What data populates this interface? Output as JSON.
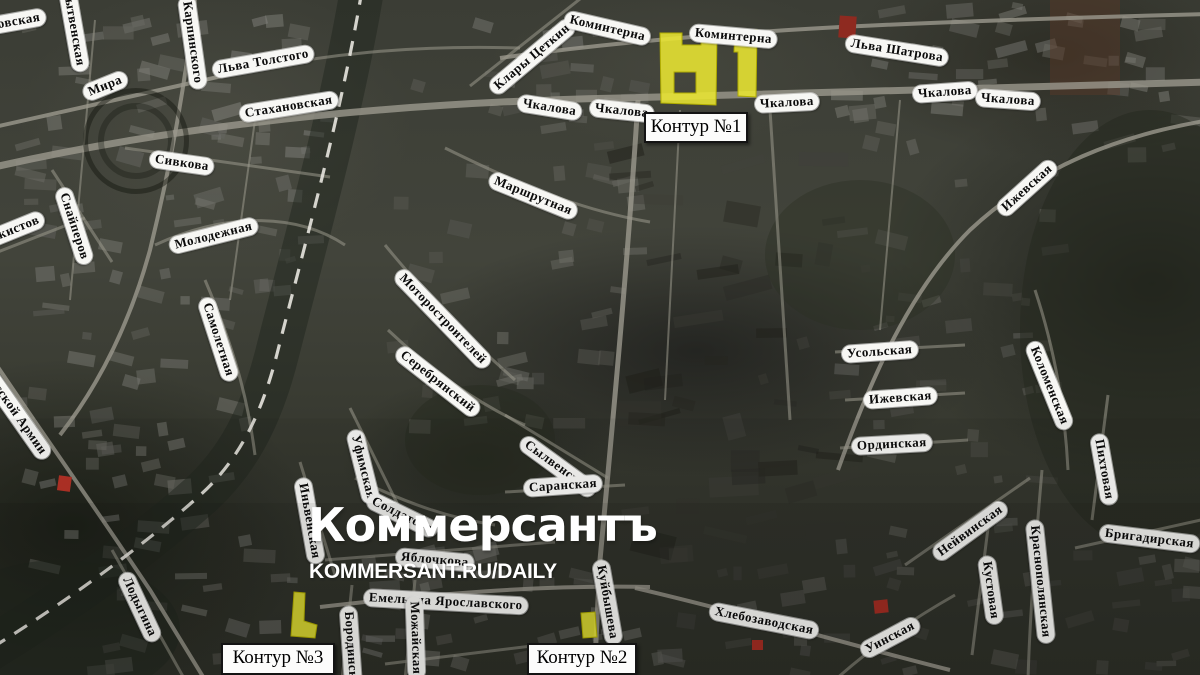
{
  "watermark": {
    "logo": "Коммерсантъ",
    "url": "KOMMERSANT.RU/DAILY"
  },
  "colors": {
    "highlight": "#e9e632",
    "highlight_stroke": "#b0ac00",
    "street_label_bg": "#f7f7f4",
    "street_label_text": "#0b0b0b",
    "callout_bg": "#fcfcfb",
    "callout_border": "#141414",
    "ground": "#3e4038",
    "road": "#9b998d",
    "railway_dash": "#e8e6df"
  },
  "map": {
    "street_labels": [
      {
        "text": "Стахановская",
        "x": -52,
        "y": 25,
        "rot": -10
      },
      {
        "text": "Нытвенская",
        "x": 66,
        "y": -25,
        "rot": 80
      },
      {
        "text": "Карпинского",
        "x": 186,
        "y": -12,
        "rot": 82
      },
      {
        "text": "Льва Толстого",
        "x": 213,
        "y": 62,
        "rot": -10
      },
      {
        "text": "Мира",
        "x": 84,
        "y": 86,
        "rot": -22
      },
      {
        "text": "Стахановская",
        "x": 240,
        "y": 106,
        "rot": -9
      },
      {
        "text": "Сивкова",
        "x": 150,
        "y": 150,
        "rot": 8
      },
      {
        "text": "Танкистов",
        "x": -28,
        "y": 238,
        "rot": -22
      },
      {
        "text": "Снайперов",
        "x": 62,
        "y": 180,
        "rot": 72
      },
      {
        "text": "Молодежная",
        "x": 170,
        "y": 238,
        "rot": -14
      },
      {
        "text": "Самолетная",
        "x": 205,
        "y": 290,
        "rot": 72
      },
      {
        "text": "Советской Армии",
        "x": -24,
        "y": 348,
        "rot": 55
      },
      {
        "text": "Маршрутная",
        "x": 490,
        "y": 170,
        "rot": 22
      },
      {
        "text": "Моторостроителей",
        "x": 398,
        "y": 264,
        "rot": 46
      },
      {
        "text": "Серебрянский",
        "x": 398,
        "y": 342,
        "rot": 38
      },
      {
        "text": "Уфимская",
        "x": 354,
        "y": 422,
        "rot": 76
      },
      {
        "text": "Иньвенская",
        "x": 302,
        "y": 470,
        "rot": 80
      },
      {
        "text": "Солдатова",
        "x": 368,
        "y": 490,
        "rot": 26
      },
      {
        "text": "Сылвенская",
        "x": 522,
        "y": 432,
        "rot": 36
      },
      {
        "text": "Саранская",
        "x": 524,
        "y": 480,
        "rot": -4
      },
      {
        "text": "Яблочкова",
        "x": 396,
        "y": 548,
        "rot": 5
      },
      {
        "text": "Емельяна Ярославского",
        "x": 364,
        "y": 589,
        "rot": 3
      },
      {
        "text": "Лодыгина",
        "x": 124,
        "y": 565,
        "rot": 65
      },
      {
        "text": "Бородинская",
        "x": 348,
        "y": 598,
        "rot": 86
      },
      {
        "text": "Можайская",
        "x": 414,
        "y": 588,
        "rot": 88
      },
      {
        "text": "Куйбышева",
        "x": 600,
        "y": 552,
        "rot": 80
      },
      {
        "text": "Хлебозаводская",
        "x": 710,
        "y": 602,
        "rot": 11
      },
      {
        "text": "Уинская",
        "x": 862,
        "y": 644,
        "rot": -28
      },
      {
        "text": "Усольская",
        "x": 842,
        "y": 346,
        "rot": -4
      },
      {
        "text": "Ижевская",
        "x": 864,
        "y": 392,
        "rot": -4
      },
      {
        "text": "Ординская",
        "x": 852,
        "y": 438,
        "rot": -3
      },
      {
        "text": "Ижевская",
        "x": 1000,
        "y": 204,
        "rot": -42
      },
      {
        "text": "Коломенская",
        "x": 1032,
        "y": 334,
        "rot": 68
      },
      {
        "text": "Нейвинская",
        "x": 935,
        "y": 548,
        "rot": -36
      },
      {
        "text": "Кустовая",
        "x": 986,
        "y": 548,
        "rot": 82
      },
      {
        "text": "Краснополянская",
        "x": 1034,
        "y": 512,
        "rot": 84
      },
      {
        "text": "Пихтовая",
        "x": 1098,
        "y": 426,
        "rot": 80
      },
      {
        "text": "Бригадирская",
        "x": 1100,
        "y": 524,
        "rot": 7
      },
      {
        "text": "Клары Цеткин",
        "x": 492,
        "y": 82,
        "rot": -40
      },
      {
        "text": "Коминтерна",
        "x": 565,
        "y": 10,
        "rot": 13
      },
      {
        "text": "Коминтерна",
        "x": 690,
        "y": 24,
        "rot": 5
      },
      {
        "text": "Льва Шатрова",
        "x": 846,
        "y": 34,
        "rot": 9
      },
      {
        "text": "Чкалова",
        "x": 518,
        "y": 94,
        "rot": 9
      },
      {
        "text": "Чкалова",
        "x": 590,
        "y": 99,
        "rot": 6
      },
      {
        "text": "Чкалова",
        "x": 755,
        "y": 96,
        "rot": -3
      },
      {
        "text": "Чкалова",
        "x": 913,
        "y": 86,
        "rot": -4
      },
      {
        "text": "Чкалова",
        "x": 976,
        "y": 89,
        "rot": 4
      }
    ],
    "contour_callouts": [
      {
        "label": "Контур №1",
        "x": 644,
        "y": 112,
        "w": 100,
        "h": 27
      },
      {
        "label": "Контур №2",
        "x": 527,
        "y": 643,
        "w": 106,
        "h": 28
      },
      {
        "label": "Контур №3",
        "x": 221,
        "y": 643,
        "w": 110,
        "h": 28
      }
    ],
    "contours": [
      {
        "name": "contour-1-left",
        "path": "M660,33 L682,33 L682,45 L701,45 L701,30 L717,31 L716,105 L661,103 Z M674,72 L696,72 L696,93 L674,93 Z"
      },
      {
        "name": "contour-1-right",
        "path": "M735,31 L757,30 L756,97 L738,96 L738,52 L734,52 Z"
      },
      {
        "name": "contour-2",
        "path": "M581,613 L595,612 L597,637 L583,638 Z"
      },
      {
        "name": "contour-3",
        "path": "M294,592 L305,593 L304,621 L317,625 L315,638 L291,636 Z"
      }
    ]
  }
}
